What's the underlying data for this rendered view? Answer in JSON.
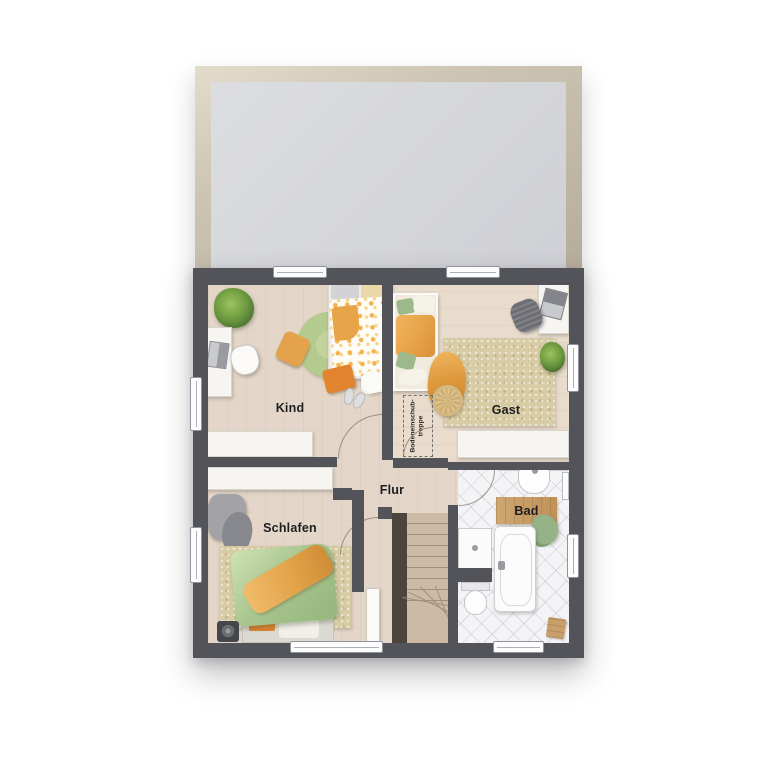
{
  "floorplan": {
    "view": "top-down upper floor plan",
    "rooms": {
      "kind": {
        "label": "Kind"
      },
      "gast": {
        "label": "Gast"
      },
      "flur": {
        "label": "Flur"
      },
      "schlafen": {
        "label": "Schlafen"
      },
      "bad": {
        "label": "Bad"
      },
      "attic_hatch": {
        "line1": "Bodeneinschub-",
        "line2": "treppe"
      }
    },
    "colors": {
      "background": "#ffffff",
      "wall": "#53545a",
      "floor_wood": "#e3d5c7",
      "floor_wood_light": "#e9dccd",
      "tile": "#f4f4f6",
      "terrace_fill": "#d6d7db",
      "terrace_frame": "#c6bdac",
      "rug_beige": "#d8cca6",
      "rug_green": "#b5ca8e",
      "stair_tread": "#ccbaa6",
      "stair_stringer": "#4d453d",
      "accent_orange": "#e8a449",
      "accent_orange_deep": "#e2832e",
      "accent_green": "#a9c690",
      "furniture_white": "#f6f5f2",
      "furniture_gray": "#94959a"
    }
  }
}
